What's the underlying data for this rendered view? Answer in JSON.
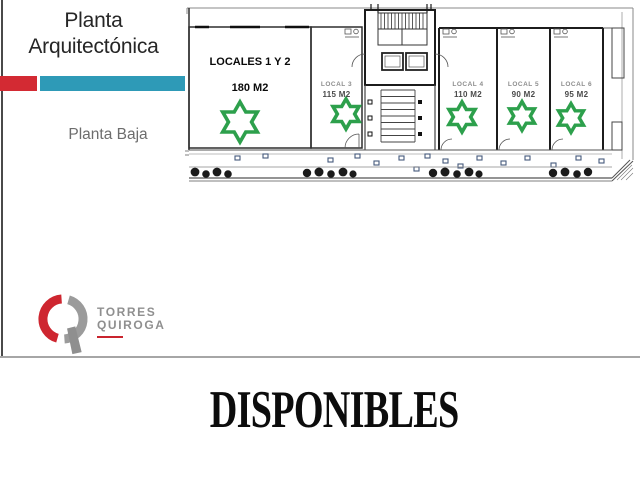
{
  "header": {
    "title": "Planta Arquitectónica",
    "subtitle": "Planta Baja"
  },
  "plan": {
    "floor_label": "Planta Baja",
    "locales": [
      {
        "name": "LOCALES 1 Y 2",
        "area": "180 M2",
        "available": true
      },
      {
        "name": "LOCAL 3",
        "area": "115 M2",
        "available": true
      },
      {
        "name": "LOCAL 4",
        "area": "110 M2",
        "available": true
      },
      {
        "name": "LOCAL 5",
        "area": "90 M2",
        "available": true
      },
      {
        "name": "LOCAL 6",
        "area": "95 M2",
        "available": true
      }
    ]
  },
  "logo": {
    "name_line1": "TORRES",
    "name_line2": "QUIROGA"
  },
  "footer": {
    "label": "DISPONIBLES"
  },
  "icons": {
    "available_star": "green-hexagram-outline"
  },
  "colors": {
    "accent_red": "#d32a33",
    "accent_teal": "#2e9ab7",
    "star_green": "#2da04c",
    "divider_gray": "#a6a6a6"
  }
}
